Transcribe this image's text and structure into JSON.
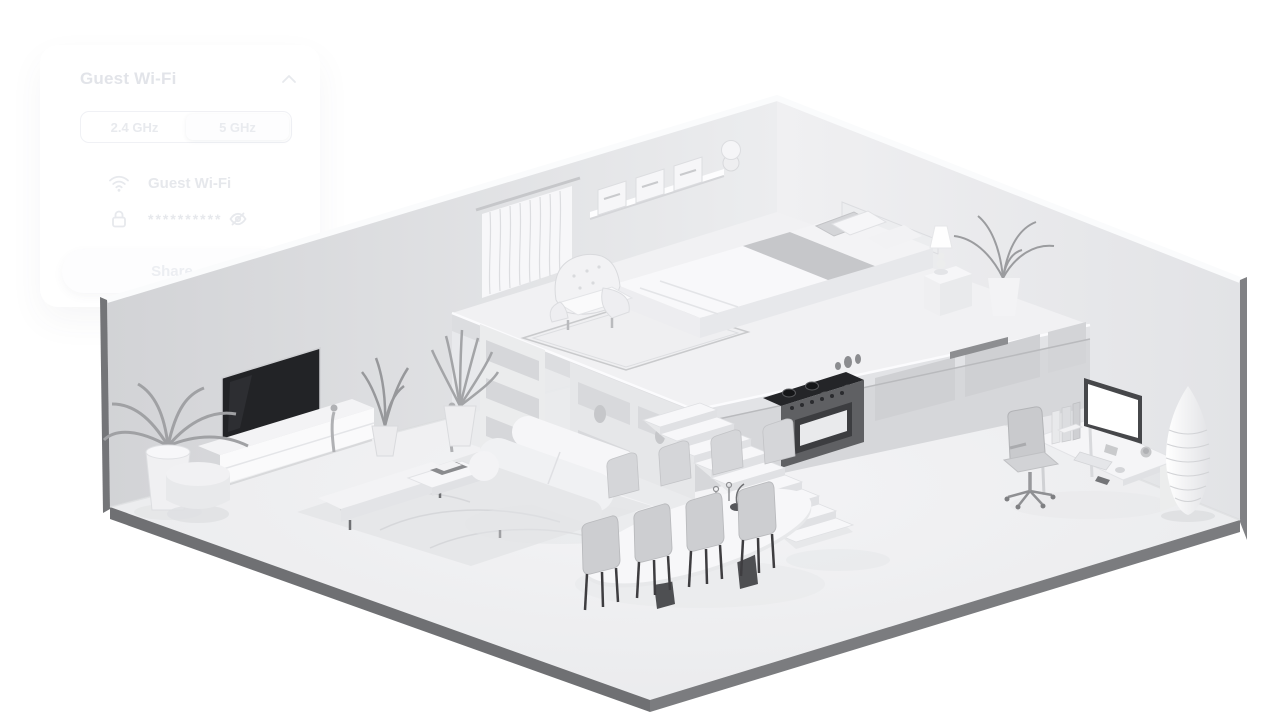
{
  "panel": {
    "title": "Guest Wi-Fi",
    "collapse_icon": "chevron-up-icon",
    "bands": [
      {
        "label": "2.4 GHz",
        "selected": false
      },
      {
        "label": "5 GHz",
        "selected": true
      }
    ],
    "network_icon": "wifi-icon",
    "network_name": "Guest Wi-Fi",
    "password_icon": "lock-icon",
    "password_mask": "**********",
    "password_visibility_icon": "eye-off-icon",
    "share_button_label": "Share"
  },
  "scene": {
    "style": "isometric 3D cutaway apartment, monochrome white render",
    "areas": [
      "bedroom mezzanine",
      "kitchen",
      "living room",
      "dining area",
      "home office"
    ],
    "colors": {
      "background": "#ffffff",
      "walls": "#e4e5e8",
      "floor": "#eeeef0",
      "edge_dark": "#717276",
      "tv_screen": "#222326",
      "stove_cooktop": "#242528"
    }
  }
}
